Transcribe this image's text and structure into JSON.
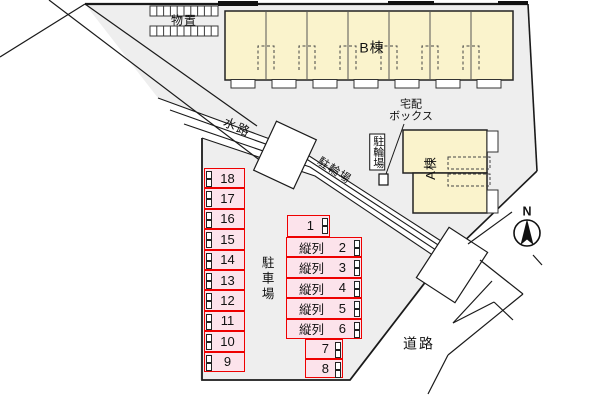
{
  "labels": {
    "storage": "物置",
    "building_b": "B棟",
    "delivery_box_line1": "宅配",
    "delivery_box_line2": "ボックス",
    "bicycle_diagonal": "駐輪場",
    "bicycle_boxed": "駐輪場",
    "waterway": "水路",
    "building_a": "A棟",
    "parking_lot": "駐車場",
    "road": "道路",
    "compass_north": "N"
  },
  "parking": {
    "left_column": [
      "18",
      "17",
      "16",
      "15",
      "14",
      "13",
      "12",
      "11",
      "10",
      "9"
    ],
    "single_top": "1",
    "tandem_rows": [
      {
        "label": "縦列",
        "number": "2"
      },
      {
        "label": "縦列",
        "number": "3"
      },
      {
        "label": "縦列",
        "number": "4"
      },
      {
        "label": "縦列",
        "number": "5"
      },
      {
        "label": "縦列",
        "number": "6"
      }
    ],
    "small_rows": [
      "7",
      "8"
    ]
  },
  "colors": {
    "site_ground": "#eeeeee",
    "building_fill": "#faf3cc",
    "parking_fill": "#fce3eb",
    "parking_border": "#ee0000",
    "line": "#1a1a1a"
  }
}
